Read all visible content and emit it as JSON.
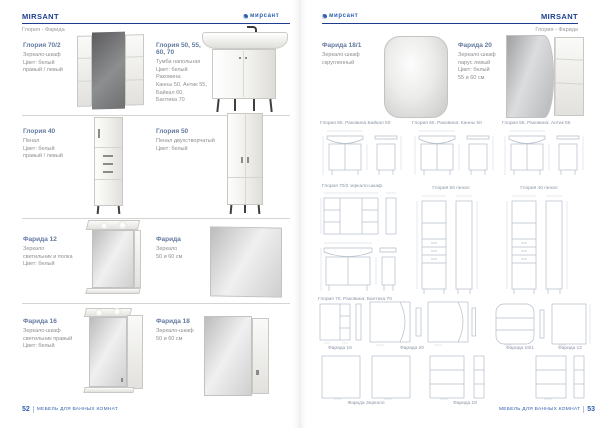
{
  "colors": {
    "brand_navy": "#1d3e8f",
    "logo_blue": "#2e5fae",
    "product_title_blue": "#64799f",
    "body_text_gray": "#8d8f92",
    "drawing_line": "#b4bdca"
  },
  "left_page": {
    "header_title": "MIRSANT",
    "logo_text": "мирсант",
    "subtitle": "Глория - Фарида",
    "products": [
      {
        "title": "Глория 70/2",
        "desc": "Зеркало-шкаф\nЦвет: белый\nправый / левый"
      },
      {
        "title": "Глория 50, 55, 60, 70",
        "desc": "Тумба напольная\nЦвет: белый\nРаковина:\nКанны 50, Антик 55,\nБайкал 60,\nБалтика 70"
      },
      {
        "title": "Глория 40",
        "desc": "Пенал\nЦвет: белый\nправый / левый"
      },
      {
        "title": "Глория 50",
        "desc": "Пенал двухстворчатый\nЦвет: белый"
      },
      {
        "title": "Фарида 12",
        "desc": "Зеркало\nсветильник и полка\nЦвет: белый"
      },
      {
        "title": "Фарида",
        "desc": "Зеркало\n50 и 60 см"
      },
      {
        "title": "Фарида 16",
        "desc": "Зеркало-шкаф\nсветильник правый\nЦвет: белый"
      },
      {
        "title": "Фарида 18",
        "desc": "Зеркало-шкаф\n50 и 60 см"
      }
    ],
    "footer": {
      "page_number": "52",
      "label": "МЕБЕЛЬ ДЛЯ ВАННЫХ КОМНАТ"
    }
  },
  "right_page": {
    "header_title": "MIRSANT",
    "logo_text": "мирсант",
    "subtitle": "Глория - Фарида",
    "products": [
      {
        "title": "Фарида 18/1",
        "desc": "Зеркало-шкаф\nскругленный"
      },
      {
        "title": "Фарида 20",
        "desc": "Зеркало-шкаф\nпарус левый\nЦвет: белый\n55 и 60 см"
      }
    ],
    "tech": {
      "row1": [
        "Глория 60. Раковина Байкал 60",
        "Глория 50. Раковина: Канны 50",
        "Глория 55. Раковина: Антик 55"
      ],
      "row2": [
        "Глория 70/2 зеркало-шкаф",
        "Глория 50 пенал",
        "Глория 40 пенал"
      ],
      "row2_bottom_label": "Глория 70. Раковина: Балтика 70",
      "row3": [
        "Фарида 16",
        "Фарида 20",
        "Фарида 18/1",
        "Фарида 12"
      ],
      "row4": [
        "Фарида Зеркало",
        "Фарида 18"
      ]
    },
    "footer": {
      "label": "МЕБЕЛЬ ДЛЯ ВАННЫХ КОМНАТ",
      "page_number": "53"
    }
  }
}
